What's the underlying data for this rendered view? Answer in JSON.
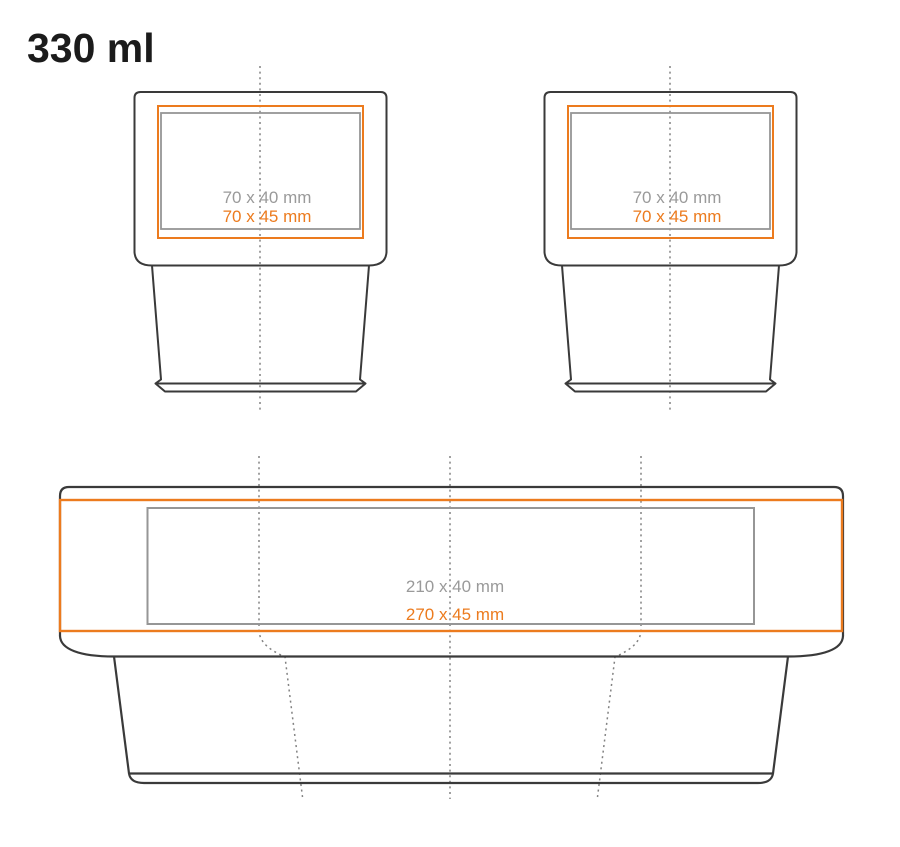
{
  "page": {
    "title": "330 ml",
    "background": "#ffffff"
  },
  "colors": {
    "outline": "#3a3a3a",
    "accent_orange": "#ec7b1e",
    "label_gray": "#9a9a9a",
    "area_gray": "#969696",
    "dash_gray": "#828282",
    "title_color": "#1b1b1b",
    "background": "#ffffff"
  },
  "views": {
    "cup_front": {
      "label_standard": "70 x 40 mm",
      "label_max": "70 x 45 mm"
    },
    "cup_back": {
      "label_standard": "70 x 40 mm",
      "label_max": "70 x 45 mm"
    },
    "wrap": {
      "label_standard": "210 x 40 mm",
      "label_max": "270 x 45 mm"
    }
  }
}
